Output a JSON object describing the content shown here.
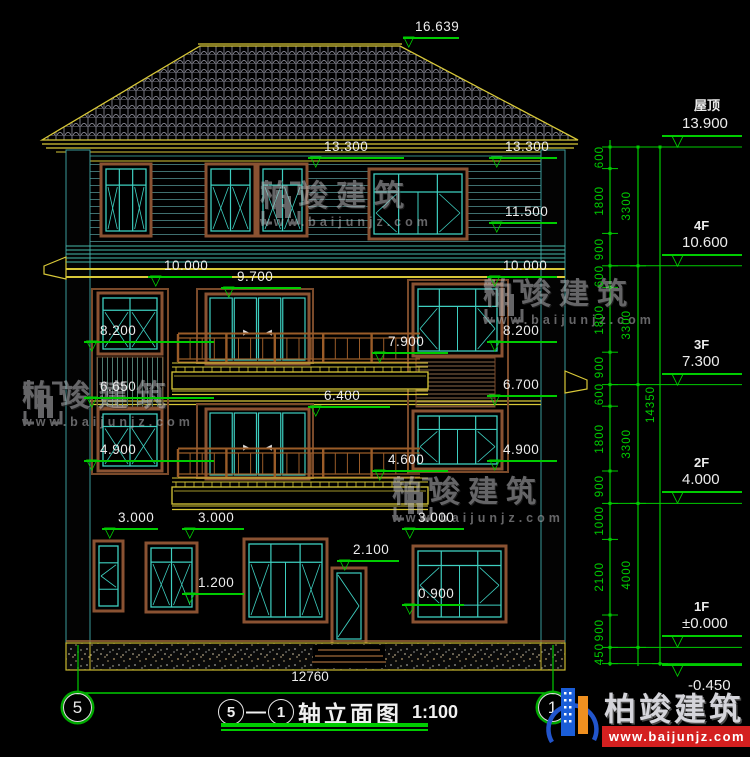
{
  "drawing": {
    "type": "建筑立面图"
  },
  "ridge_marker": "16.639",
  "facade_markers": [
    "16.639",
    "13.300",
    "13.300",
    "11.500",
    "10.000",
    "9.700",
    "10.000",
    "8.200",
    "7.900",
    "8.200",
    "6.650",
    "6.400",
    "6.700",
    "4.900",
    "4.600",
    "4.900",
    "3.000",
    "3.000",
    "3.000",
    "2.100",
    "1.200",
    "0.900"
  ],
  "levels": [
    {
      "floor": "屋顶",
      "value": "13.900"
    },
    {
      "floor": "4F",
      "value": "10.600"
    },
    {
      "floor": "3F",
      "value": "7.300"
    },
    {
      "floor": "2F",
      "value": "4.000"
    },
    {
      "floor": "1F",
      "value": "±0.000"
    },
    {
      "floor": "",
      "value": "-0.450"
    }
  ],
  "dims_right_inner": [
    "600",
    "1800",
    "900",
    "600",
    "1800",
    "900",
    "600",
    "1800",
    "900",
    "1000",
    "2100",
    "900",
    "450"
  ],
  "dims_right_middle": [
    "3300",
    "3300",
    "3300",
    "4000"
  ],
  "dims_right_total": "14350",
  "bottom": {
    "overall_width": "12760",
    "grid_bubble_left": "5",
    "grid_bubble_right": "1"
  },
  "title": {
    "bubble_start": "5",
    "separator": "—",
    "bubble_end": "1",
    "name": "轴立面图",
    "scale": "1:100"
  },
  "watermark": {
    "name": "柏竣建筑",
    "url": "www.baijunjz.com"
  },
  "logo": {
    "name": "柏竣建筑",
    "url": "www.baijunjz.com"
  },
  "colors": {
    "dimension_green": "#00cc00",
    "line_yellow": "#d8c838",
    "window_teal": "#3ecfc0",
    "frame_brown": "#8a5232",
    "railing_brown": "#9a5c28",
    "siding_teal": "#3f6f6f",
    "tile_gray": "#a8a8b8",
    "text_white": "#ececec",
    "logo_red": "#d42020",
    "logo_blue": "#1a5dd8",
    "logo_orange": "#f09020"
  }
}
